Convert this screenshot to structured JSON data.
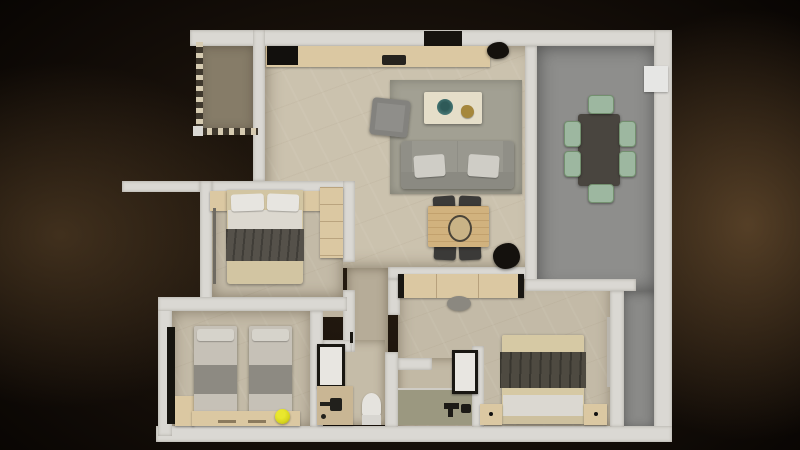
{
  "scene": {
    "title": "apartment-floor-plan-3d-render",
    "style": "top-down 3D rendered floor plan on dark vignette background"
  },
  "palette": {
    "background": "#0d0805",
    "vignette_brown": "#46351f",
    "wall": "#dad8d3",
    "floor_beige": "#cbc2ae",
    "floor_terrace_dark_beige": "#867c68",
    "floor_gray_terrace": "#8e8e8c",
    "floor_bath_green": "#9b9880",
    "wood_light": "#dbc8a2",
    "sofa_gray": "#99988f",
    "chair_sage_green": "#9db7a0",
    "dining_table_dark": "#49453f",
    "bedding_beige": "#d2c5a2",
    "bed_throw_dark_gray": "#55514a",
    "accent_yellow_ball": "#d8d61e",
    "accent_teal_bowl": "#3f6f6d",
    "accent_gold_decor": "#a5873c",
    "shower_frame_black": "#191712"
  },
  "rooms": [
    {
      "id": "living-kitchen",
      "floor": "beige-marble"
    },
    {
      "id": "open-terrace-top-left",
      "floor": "dark-beige",
      "boundary": "dashed"
    },
    {
      "id": "gray-terrace-dining",
      "floor": "gray",
      "shape": "L"
    },
    {
      "id": "bedroom-1-left",
      "floor": "beige"
    },
    {
      "id": "bedroom-2-bottom-left",
      "floor": "beige"
    },
    {
      "id": "bedroom-3-bottom-right",
      "floor": "beige"
    },
    {
      "id": "bathroom-1",
      "floor": "beige"
    },
    {
      "id": "bathroom-2",
      "floor": "beige-green"
    },
    {
      "id": "corridor",
      "floor": "beige"
    }
  ],
  "furniture": {
    "kitchen": [
      "counter-with-black-cooktop",
      "sink",
      "plant"
    ],
    "living": [
      "area-rug",
      "sofa-2-pillows",
      "armchair",
      "coffee-table-teal-bowl-gold-decor",
      "plant"
    ],
    "gray_terrace": [
      "dining-table",
      "6-sage-chairs",
      "white-ac-unit"
    ],
    "center": [
      "wood-desk-table",
      "4-dark-chairs",
      "centerpiece",
      "sideboard-dark-ends",
      "pouf"
    ],
    "bedroom_1": [
      "double-bed-dark-throw",
      "2-white-pillows",
      "2-nightstands",
      "wardrobe"
    ],
    "bedroom_2": [
      "single-bed",
      "single-bed",
      "headboard-console",
      "yellow-ball",
      "tall-dark-cabinet",
      "wood-cabinet"
    ],
    "bedroom_3": [
      "double-bed-dark-throw",
      "2-nightstands-with-knobs"
    ],
    "bathroom_1": [
      "framed-shower",
      "vanity-with-sink",
      "toilet"
    ],
    "bathroom_2": [
      "framed-shower",
      "walk-in-shower-fixtures"
    ]
  }
}
